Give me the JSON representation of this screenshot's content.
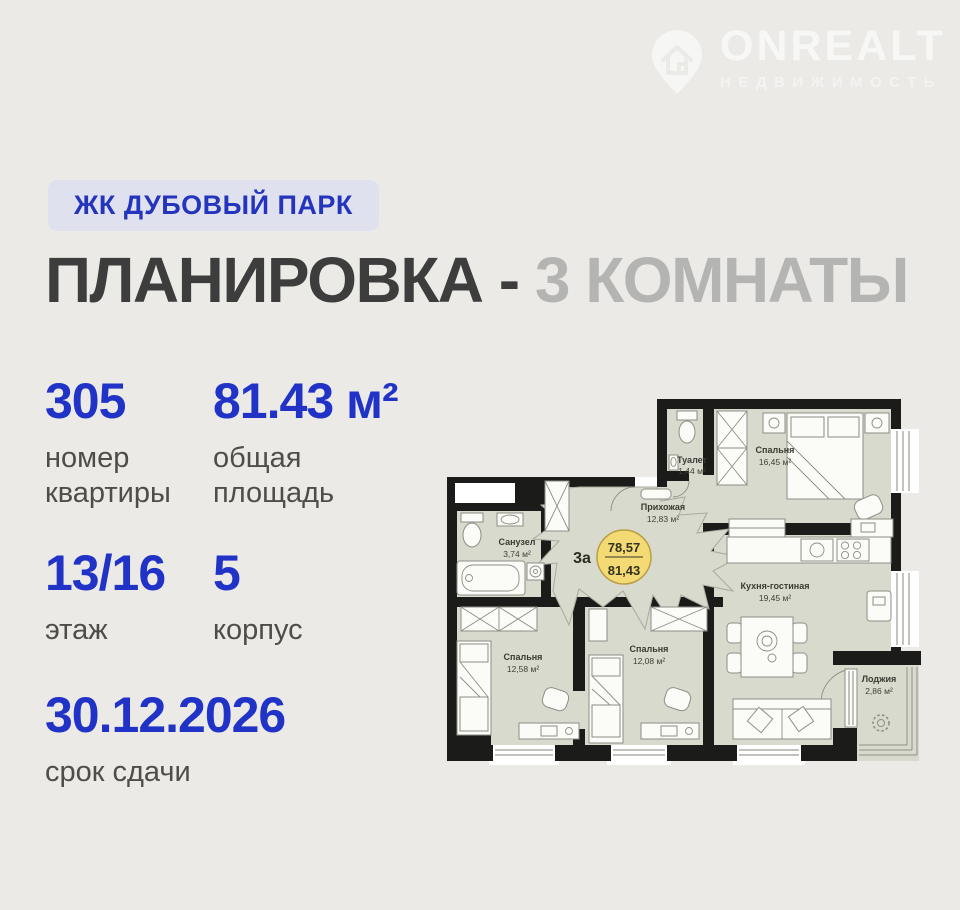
{
  "watermark": {
    "brand": "ONREALT",
    "tagline": "НЕДВИЖИМОСТЬ"
  },
  "project_badge": "ЖК ДУБОВЫЙ ПАРК",
  "title": {
    "primary": "ПЛАНИРОВКА - ",
    "secondary": "3 КОМНАТЫ"
  },
  "stats": {
    "apartment_number": {
      "value": "305",
      "label": "номер\nквартиры"
    },
    "total_area": {
      "value": "81.43 м²",
      "label": "общая\nплощадь"
    },
    "floor": {
      "value": "13/16",
      "label": "этаж"
    },
    "building": {
      "value": "5",
      "label": "корпус"
    },
    "completion": {
      "value": "30.12.2026",
      "label": "срок сдачи"
    }
  },
  "floorplan": {
    "unit_type": "3а",
    "area_living": "78,57",
    "area_total": "81,43",
    "rooms": {
      "toilet": {
        "name": "Туалет",
        "area": "1,44 м²"
      },
      "bedroom_large": {
        "name": "Спальня",
        "area": "16,45 м²"
      },
      "hallway": {
        "name": "Прихожая",
        "area": "12,83 м²"
      },
      "bathroom": {
        "name": "Санузел",
        "area": "3,74 м²"
      },
      "kitchen_living": {
        "name": "Кухня-гостиная",
        "area": "19,45 м²"
      },
      "bedroom_left": {
        "name": "Спальня",
        "area": "12,58 м²"
      },
      "bedroom_mid": {
        "name": "Спальня",
        "area": "12,08 м²"
      },
      "loggia": {
        "name": "Лоджия",
        "area": "2,86 м²"
      }
    }
  },
  "colors": {
    "background": "#ebeae7",
    "accent_blue": "#2133c7",
    "badge_bg": "#dfe2ee",
    "title_dark": "#3d3d3d",
    "title_light": "#b4b4b2",
    "plan_room_fill": "#d9dace",
    "plan_wall": "#1b1b19",
    "unit_circle_yellow": "#f3da74"
  }
}
